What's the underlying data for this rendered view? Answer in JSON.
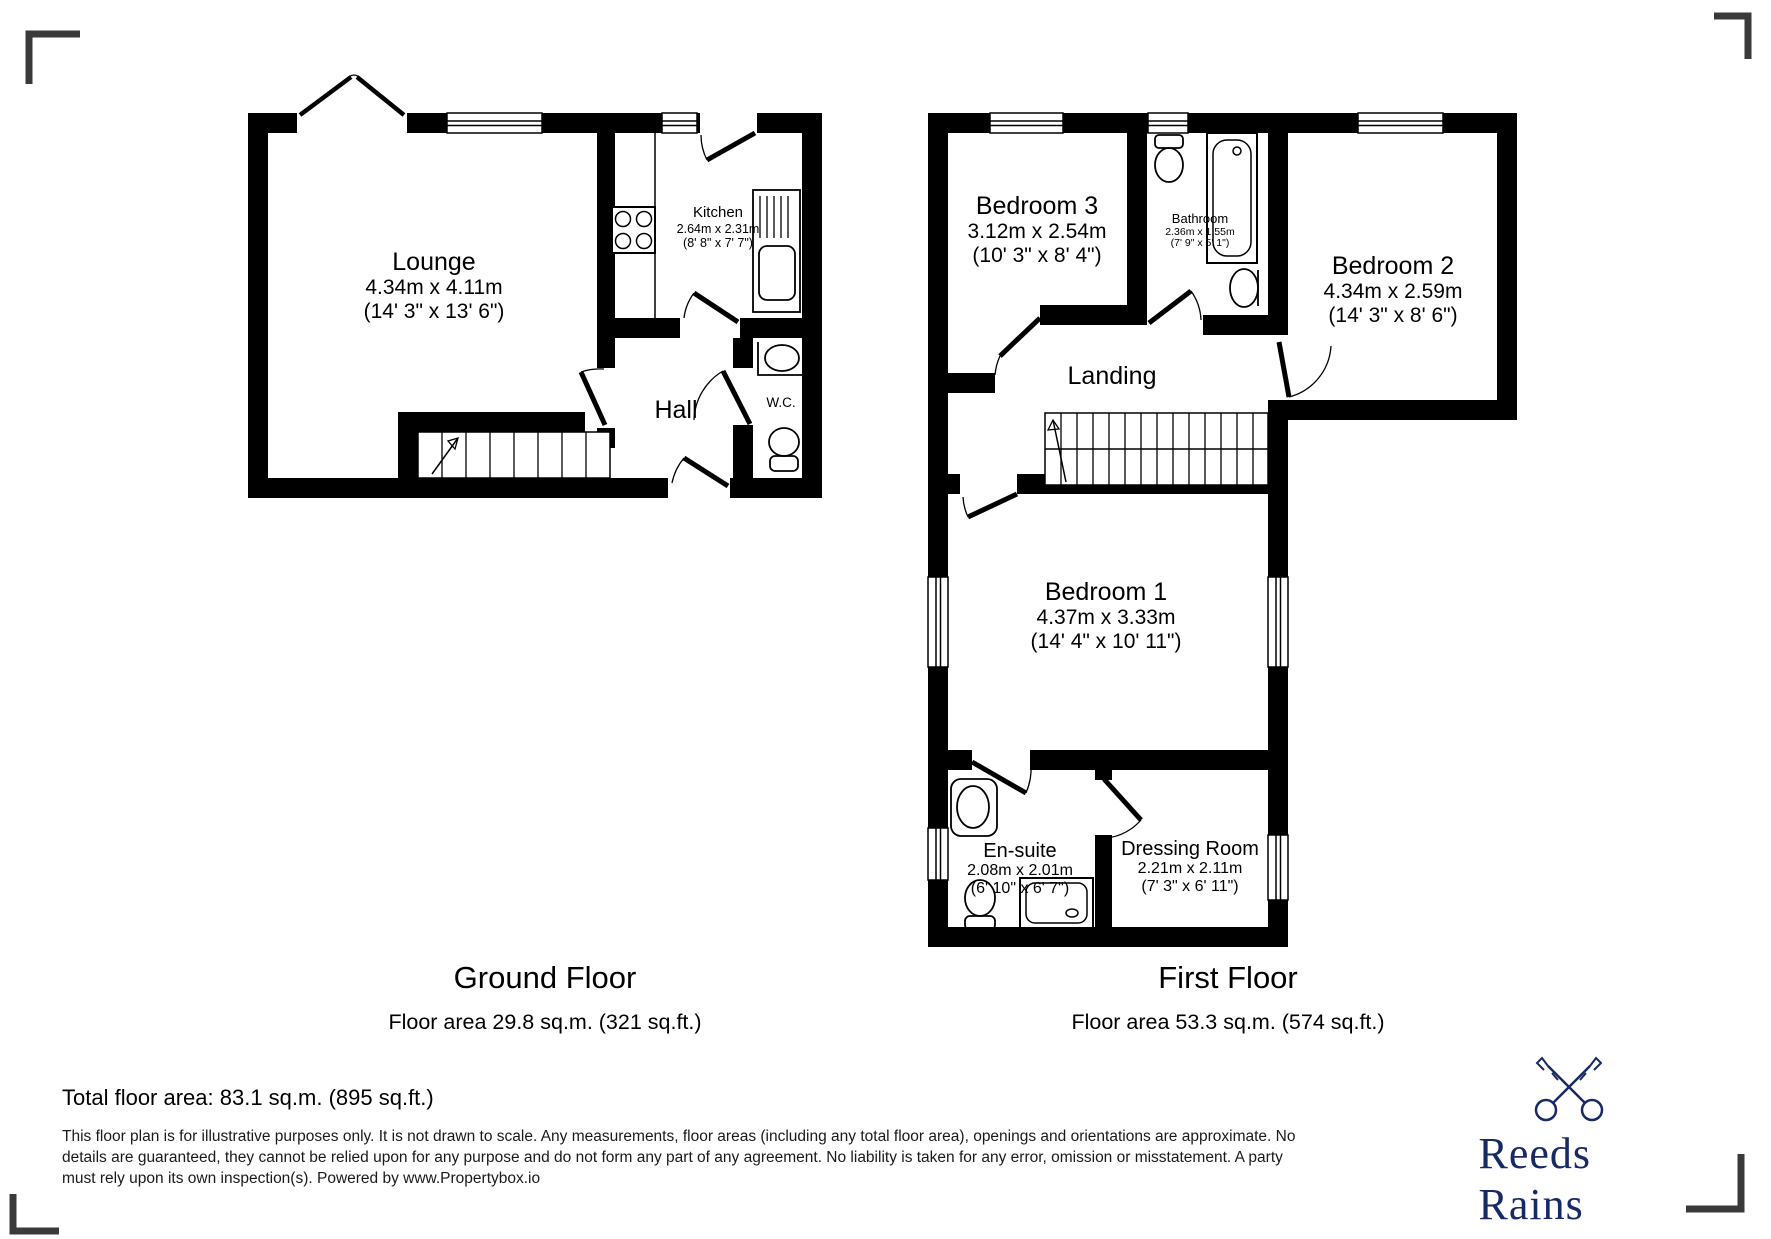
{
  "ground_floor": {
    "title": "Ground Floor",
    "area_label": "Floor area 29.8 sq.m. (321 sq.ft.)",
    "rooms": {
      "lounge": {
        "name": "Lounge",
        "metric": "4.34m x 4.11m",
        "imperial": "(14' 3\" x 13' 6\")"
      },
      "kitchen": {
        "name": "Kitchen",
        "metric": "2.64m x 2.31m",
        "imperial": "(8' 8\" x 7' 7\")"
      },
      "hall": {
        "name": "Hall"
      },
      "wc": {
        "name": "W.C."
      }
    }
  },
  "first_floor": {
    "title": "First Floor",
    "area_label": "Floor area 53.3 sq.m. (574 sq.ft.)",
    "rooms": {
      "bedroom3": {
        "name": "Bedroom 3",
        "metric": "3.12m x 2.54m",
        "imperial": "(10' 3\" x 8' 4\")"
      },
      "bathroom": {
        "name": "Bathroom",
        "metric": "2.36m x 1.55m",
        "imperial": "(7' 9\" x 5' 1\")"
      },
      "bedroom2": {
        "name": "Bedroom 2",
        "metric": "4.34m x 2.59m",
        "imperial": "(14' 3\" x 8' 6\")"
      },
      "landing": {
        "name": "Landing"
      },
      "bedroom1": {
        "name": "Bedroom 1",
        "metric": "4.37m x 3.33m",
        "imperial": "(14' 4\" x 10' 11\")"
      },
      "ensuite": {
        "name": "En-suite",
        "metric": "2.08m x 2.01m",
        "imperial": "(6' 10\" x 6' 7\")"
      },
      "dressing": {
        "name": "Dressing Room",
        "metric": "2.21m x 2.11m",
        "imperial": "(7' 3\" x 6' 11\")"
      }
    }
  },
  "summary": {
    "total_area": "Total floor area: 83.1 sq.m. (895 sq.ft.)"
  },
  "disclaimer": {
    "lines": [
      "This floor plan is for illustrative purposes only. It is not drawn to scale. Any measurements, floor areas (including any total floor area), openings and orientations are approximate. No",
      "details are guaranteed, they cannot be relied upon for any purpose and do not form any part of any agreement. No liability is taken for any error, omission or misstatement. A party",
      "must rely upon its own inspection(s). Powered by www.Propertybox.io"
    ]
  },
  "brand": {
    "name": "Reeds Rains",
    "color": "#182a66"
  }
}
